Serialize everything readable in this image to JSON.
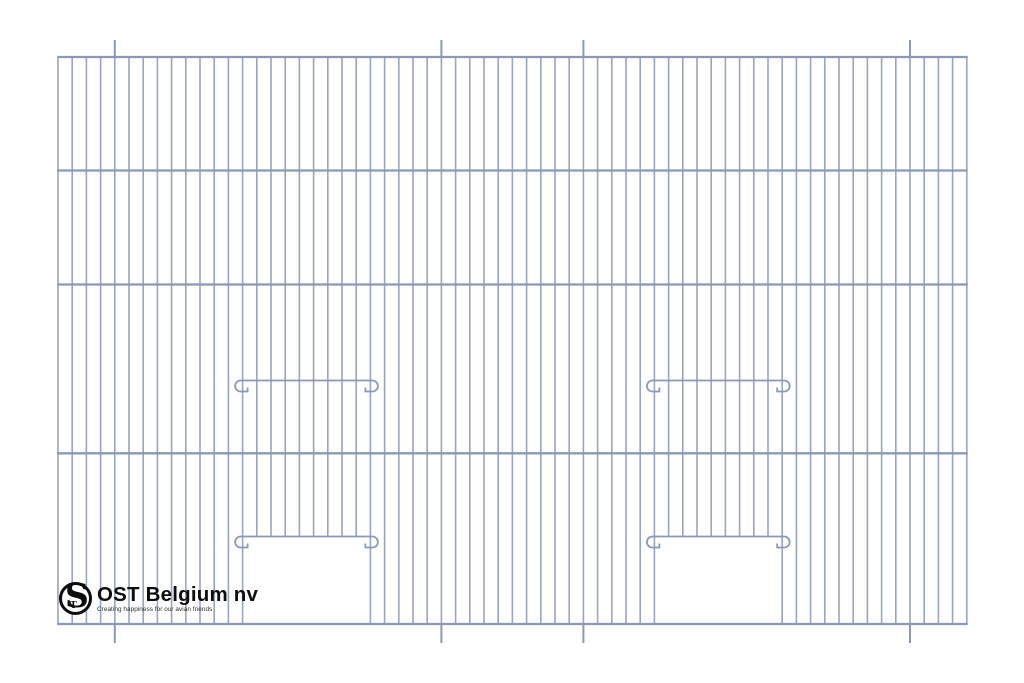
{
  "document": {
    "width": 1024,
    "height": 683,
    "background": "#ffffff",
    "description": "Technical line drawing of a bird-cage front wire panel with two feeder door openings and perch rails"
  },
  "brand": {
    "company": "OST Belgium nv",
    "tagline": "Creating happiness for our avian friends",
    "monogram": "S",
    "monogram_sub": "T",
    "logo_color": "#0d0d0d"
  },
  "drawing": {
    "type": "cage-front-panel",
    "wire_color": "#98a5bf",
    "rail_color": "#8b99b5",
    "panel": {
      "left": 58,
      "top": 57,
      "bottom": 624
    },
    "wire_spacing": 14.2,
    "wire_count": 65,
    "wire_width": 1.6,
    "rail_width": 2.3,
    "rails_y": [
      57,
      170.5,
      284.5,
      453.3,
      624
    ],
    "registration_ticks": {
      "wire_indices": [
        4,
        27,
        37,
        60
      ],
      "top_length": 17,
      "bottom_length": 19,
      "width": 2
    },
    "doors": [
      {
        "left_wire": 13,
        "right_wire": 22,
        "top_y": 536.5
      },
      {
        "left_wire": 42,
        "right_wire": 51,
        "top_y": 536.5
      }
    ],
    "perch_bars": [
      {
        "left_wire": 13,
        "right_wire": 22,
        "y": 380.5
      },
      {
        "left_wire": 42,
        "right_wire": 51,
        "y": 380.5
      },
      {
        "left_wire": 13,
        "right_wire": 22,
        "y": 536.5
      },
      {
        "left_wire": 42,
        "right_wire": 51,
        "y": 536.5
      }
    ],
    "hook": {
      "radius": 5.5,
      "stub": 5,
      "stub_lift": 4
    }
  }
}
